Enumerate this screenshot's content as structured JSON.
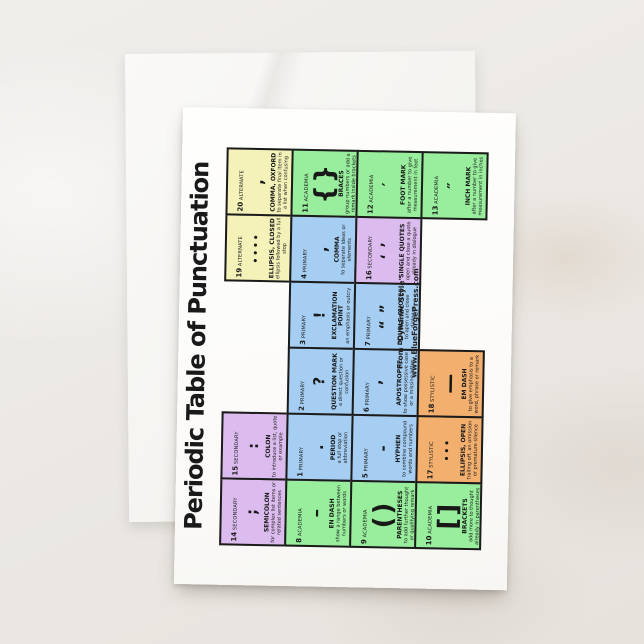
{
  "card": {
    "title": "Periodic Table of Punctuation",
    "credit_line1": "From \"Dynamic Style\"",
    "credit_line2": "www.BlueForgePress.com"
  },
  "category_colors": {
    "primary": "#A6CEF2",
    "secondary": "#DCBCEE",
    "academia": "#98EE9C",
    "alternate": "#F4F2B9",
    "stylistic": "#F2AF6E"
  },
  "table": {
    "rows": 4,
    "cols": 6,
    "cells": [
      {
        "num": "14",
        "category": "SECONDARY",
        "symbol": ";",
        "name": "SEMICOLON",
        "desc": "for complex list items or related sentences",
        "color": "secondary",
        "row": 0,
        "col": 0
      },
      {
        "num": "15",
        "category": "SECONDARY",
        "symbol": ":",
        "name": "COLON",
        "desc": "to introduce a list, quote or example",
        "color": "secondary",
        "row": 0,
        "col": 1
      },
      {
        "num": "19",
        "category": "ALTERNATE",
        "symbol": "••••",
        "name": "ELLIPSIS, CLOSED",
        "desc": "ellipsis followed by a full stop",
        "color": "alternate",
        "row": 0,
        "col": 4
      },
      {
        "num": "20",
        "category": "ALTERNATE",
        "symbol": ",",
        "name": "COMMA, OXFORD",
        "desc": "to separate final item in a list when confusing",
        "color": "alternate",
        "row": 0,
        "col": 5
      },
      {
        "num": "8",
        "category": "ACADEMIA",
        "symbol": "–",
        "name": "EN DASH",
        "desc": "show a range between numbers or words",
        "color": "academia",
        "row": 1,
        "col": 0
      },
      {
        "num": "1",
        "category": "PRIMARY",
        "symbol": ".",
        "name": "PERIOD",
        "desc": "a full stop or abbreviation",
        "color": "primary",
        "row": 1,
        "col": 1
      },
      {
        "num": "2",
        "category": "PRIMARY",
        "symbol": "?",
        "name": "QUESTION MARK",
        "desc": "a direct question or confusion",
        "color": "primary",
        "row": 1,
        "col": 2
      },
      {
        "num": "3",
        "category": "PRIMARY",
        "symbol": "!",
        "name": "EXCLAMATION POINT",
        "desc": "an emphasis or outcry",
        "color": "primary",
        "row": 1,
        "col": 3
      },
      {
        "num": "4",
        "category": "PRIMARY",
        "symbol": ",",
        "name": "COMMA",
        "desc": "to separate ideas or elements",
        "color": "primary",
        "row": 1,
        "col": 4
      },
      {
        "num": "11",
        "category": "ACADEMIA",
        "symbol": "{}",
        "name": "BRACES",
        "desc": "group numbers or add a remark inside brackets",
        "color": "academia",
        "row": 1,
        "col": 5
      },
      {
        "num": "9",
        "category": "ACADEMIA",
        "symbol": "()",
        "name": "PARENTHESES",
        "desc": "to add further thought or qualifying remark",
        "color": "academia",
        "row": 2,
        "col": 0
      },
      {
        "num": "5",
        "category": "PRIMARY",
        "symbol": "-",
        "name": "HYPHEN",
        "desc": "to combine compound words and numbers",
        "color": "primary",
        "row": 2,
        "col": 1
      },
      {
        "num": "6",
        "category": "PRIMARY",
        "symbol": "’",
        "name": "APOSTROPHE",
        "desc": "to show possessive case or a missing letter",
        "color": "primary",
        "row": 2,
        "col": 2
      },
      {
        "num": "7",
        "category": "PRIMARY",
        "symbol": "“ ”",
        "name": "DOUBLE QUOTES",
        "desc": "to open and close dialogue",
        "color": "primary",
        "row": 2,
        "col": 3
      },
      {
        "num": "16",
        "category": "SECONDARY",
        "symbol": "‘ ’",
        "name": "SINGLE QUOTES",
        "desc": "open and close a quote already in dialogue",
        "color": "secondary",
        "row": 2,
        "col": 4
      },
      {
        "num": "12",
        "category": "ACADEMIA",
        "symbol": "′",
        "name": "FOOT MARK",
        "desc": "after a number to give measurement in feet",
        "color": "academia",
        "row": 2,
        "col": 5
      },
      {
        "num": "10",
        "category": "ACADEMIA",
        "symbol": "[]",
        "name": "BRACKETS",
        "desc": "add more to thought already in parentheses",
        "color": "academia",
        "row": 3,
        "col": 0
      },
      {
        "num": "17",
        "category": "STYLISTIC",
        "symbol": "•••",
        "name": "ELLIPSIS, OPEN",
        "desc": "trailing off, an omission or premature silence",
        "color": "stylistic",
        "row": 3,
        "col": 1
      },
      {
        "num": "18",
        "category": "STYLISTIC",
        "symbol": "—",
        "name": "EM DASH",
        "desc": "to give emphasis to a word, phrase or remark",
        "color": "stylistic",
        "row": 3,
        "col": 2
      },
      {
        "num": "13",
        "category": "ACADEMIA",
        "symbol": "″",
        "name": "INCH MARK",
        "desc": "after a number to give measurement in inches",
        "color": "academia",
        "row": 3,
        "col": 5
      }
    ],
    "credit_cell": {
      "row": 3,
      "col": 3,
      "span": 2
    }
  }
}
